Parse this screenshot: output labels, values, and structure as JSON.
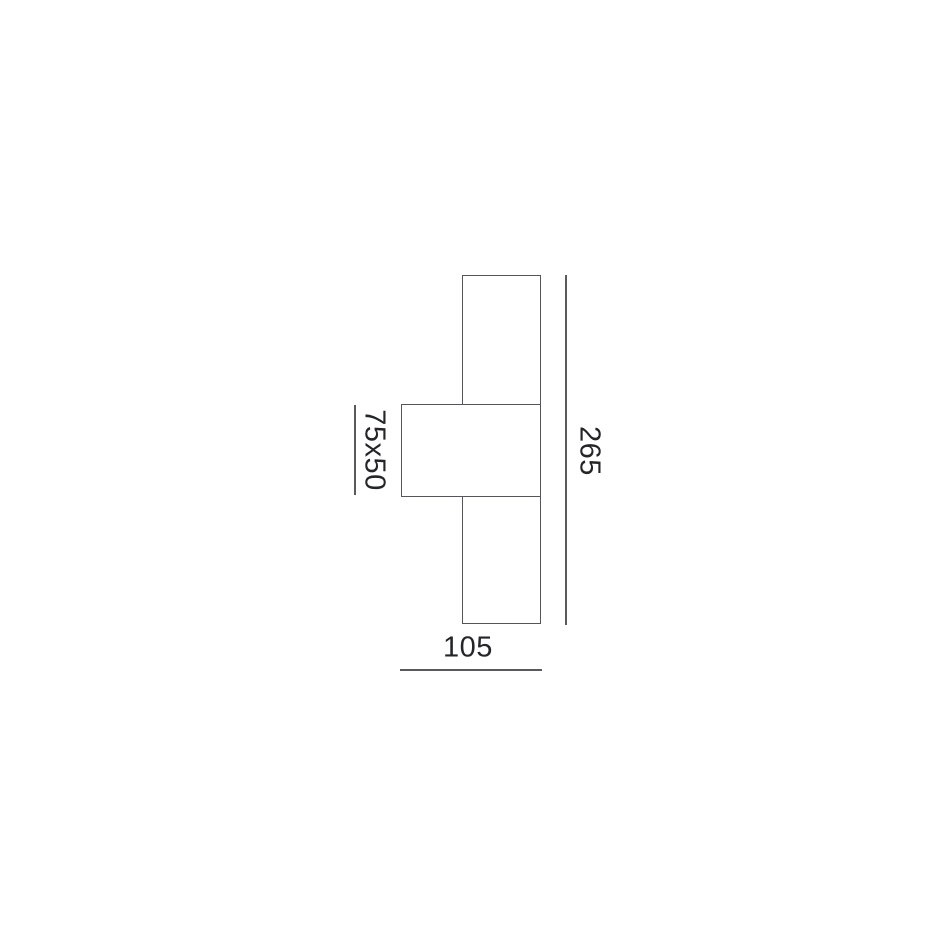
{
  "drawing": {
    "type": "product-dimension-diagram",
    "labels": {
      "overall_height": "265",
      "overall_width": "105",
      "profile_section": "75x50"
    },
    "colors": {
      "line": "#55565a",
      "text": "#242528",
      "background": "#ffffff"
    },
    "shapes": {
      "body": "tall vertical rectangle",
      "mount": "middle bracket rectangle overlapping body"
    }
  }
}
